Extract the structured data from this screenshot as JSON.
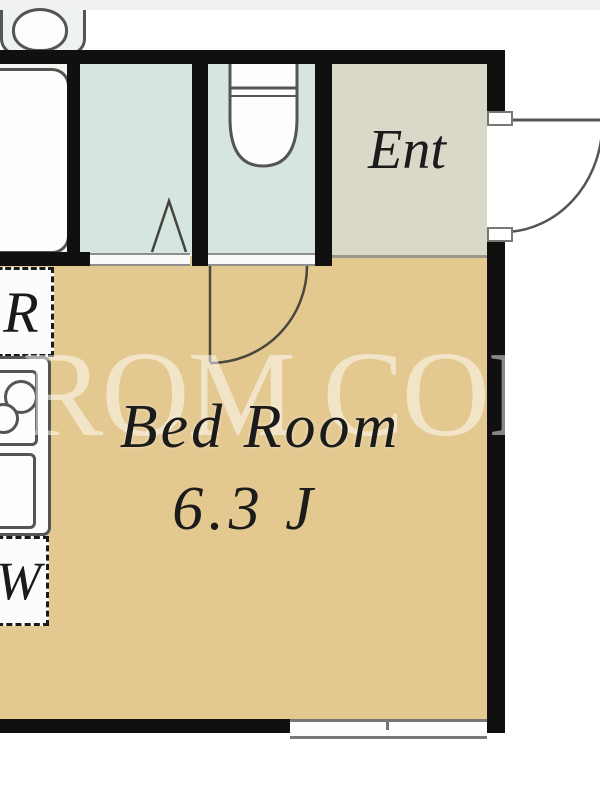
{
  "floorplan": {
    "bedroom": {
      "name": "Bed Room",
      "size": "6.3 J",
      "floor_color": "#e3c88f"
    },
    "entrance": {
      "label": "Ent",
      "floor_color": "#d9d8c9"
    },
    "washroom": {
      "floor_color": "#d6e5e0"
    },
    "toilet_room": {
      "floor_color": "#d6e5e0"
    },
    "bath_room": {
      "floor_color": "#f3f5f1"
    },
    "kitchen": {
      "refrigerator_label": "R",
      "washer_label": "W"
    },
    "watermark": {
      "text": "ROM COR",
      "color": "rgba(255,255,255,0.5)"
    },
    "colors": {
      "wall": "#101010",
      "fixture_outline": "#555555",
      "door_line": "#4a473d",
      "label_text": "#1b1b1b",
      "threshold_edge": "#8e8e8e",
      "window_frame": "#777777"
    },
    "icons": [
      "bathtub-icon",
      "sink-icon",
      "toilet-icon",
      "stove-icon",
      "kitchen-sink-icon",
      "window-icon",
      "door-arc-icon"
    ]
  }
}
